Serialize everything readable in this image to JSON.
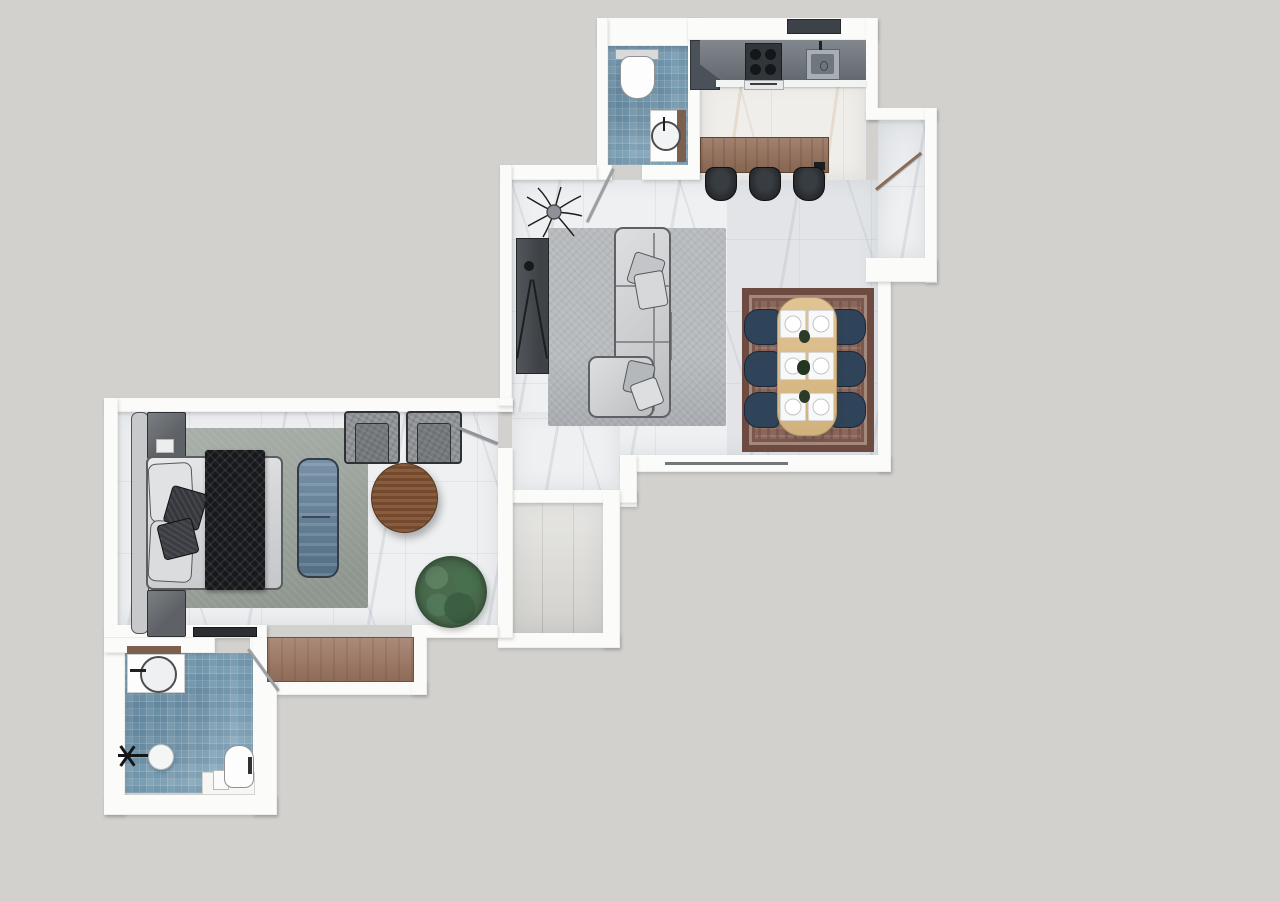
{
  "meta": {
    "type": "floor-plan-render",
    "view": "top-down",
    "canvas": {
      "width": 1280,
      "height": 901
    }
  },
  "palette": {
    "bg": "#d3d1cd",
    "wall": "#fbfbfa",
    "marble": "#eef0f2",
    "mosaic": "#7ba0b6",
    "graytile": "#dad9d5",
    "counter": "#6d747b",
    "counterDark": "#31363b",
    "steel": "#a7aeb4",
    "wood": "#95705a",
    "woodDark": "#7c5335",
    "stool": "#24272a",
    "rugGray": "#b7babd",
    "rugGreen": "#9ea69f",
    "rugRed": "#8a675a",
    "rugRedB": "#6e4b41",
    "tableWood": "#d9bd8d",
    "navy": "#2f4359",
    "sofa": "#cbcdcf",
    "charcoal": "#3f4347",
    "throw": "#17181b",
    "bench": "#5f7d96",
    "armchair": "#8e9194",
    "nightstand": "#5e6266",
    "dresser": "#9b7460",
    "plantA": "#4a6b4d",
    "plantB": "#2f4c36",
    "door": "#9aa0a5",
    "doorWood": "#8a6a55"
  },
  "rooms": [
    {
      "id": "kitchen",
      "label": "Kitchen",
      "items": [
        "counter",
        "cooktop",
        "range-hood",
        "kitchen-sink",
        "tall-cabinet",
        "oven",
        "island",
        "bar-stools"
      ]
    },
    {
      "id": "living-room",
      "label": "Living room",
      "items": [
        "sectional-sofa",
        "throw-pillows",
        "area-rug",
        "tv-console",
        "branch-decor",
        "window"
      ]
    },
    {
      "id": "dining-area",
      "label": "Dining area",
      "items": [
        "dining-table",
        "dining-chairs",
        "place-settings",
        "oriental-rug",
        "centerpieces"
      ]
    },
    {
      "id": "entry",
      "label": "Entry alcove",
      "items": [
        "entry-door"
      ]
    },
    {
      "id": "bathroom-guest",
      "label": "Guest bathroom (top)",
      "items": [
        "toilet",
        "washbasin",
        "door"
      ]
    },
    {
      "id": "bedroom",
      "label": "Bedroom",
      "items": [
        "double-bed",
        "headboard",
        "nightstands",
        "throw-blanket",
        "bench",
        "armchairs",
        "round-table",
        "plant",
        "area-rug",
        "wall-tv",
        "door"
      ]
    },
    {
      "id": "bathroom-master",
      "label": "Master bathroom (bottom)",
      "items": [
        "washbasin",
        "shower",
        "toilet",
        "platform",
        "door"
      ]
    },
    {
      "id": "balcony",
      "label": "Balcony / storage",
      "items": []
    },
    {
      "id": "wardrobe-niche",
      "label": "Wardrobe niche",
      "items": [
        "dresser"
      ]
    }
  ],
  "counts": {
    "bar_stools": 3,
    "dining_chairs": 6,
    "place_settings": 6,
    "centerpieces": 3,
    "armchairs": 2,
    "nightstands": 2,
    "sofa_pillows": 4,
    "bed_pillows": 4
  }
}
